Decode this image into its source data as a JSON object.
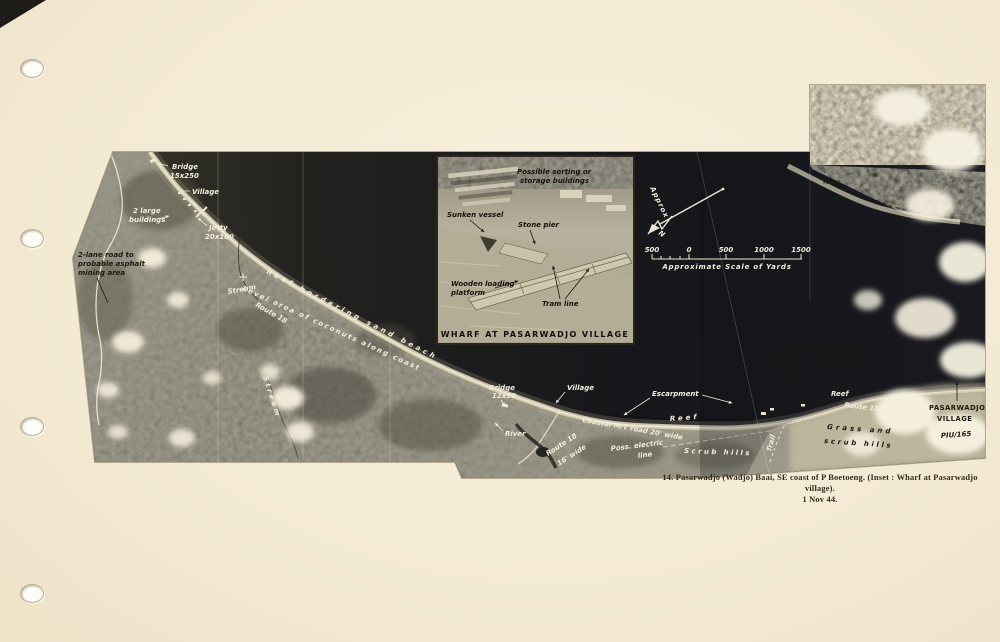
{
  "page": {
    "caption": {
      "line1": "14.  Pasarwadjo (Wadjo) Baai, SE coast of P Boetoeng.   (Inset :  Wharf at Pasarwadjo village).",
      "line2": "1 Nov 44."
    }
  },
  "colors": {
    "page_bg": "#f4ebd6",
    "sea_dark": "#1c1c1f",
    "land": "#87836f",
    "label_light": "#f1ecdb",
    "label_dark": "#1c1913"
  },
  "photo": {
    "annotations": {
      "bridge_nw_1": "Bridge",
      "bridge_nw_2": "15x250",
      "village_nw": "Village",
      "large_bldgs_nw_1": "2 large",
      "large_bldgs_nw_2": "buildings",
      "jetty_1": "Jetty",
      "jetty_2": "20x100",
      "two_lane_1": "2-lane road to",
      "two_lane_2": "probable asphalt",
      "two_lane_3": "mining area",
      "stream": "Stream",
      "stream_vertical": "Stream",
      "route18_nw": "Route 18",
      "coast_line1": "Reef bordering sand beach",
      "coast_line2": "Level area of coconuts along coast",
      "bridge_s_1": "Bridge",
      "bridge_s_2": "12x50",
      "river": "River",
      "village_s": "Village",
      "escarpment": "Escarpment",
      "coastal_road": "Coastal M/T road 20' wide",
      "route18_s_1": "Route 18",
      "route18_s_2": "16' wide",
      "poss_electric_1": "Poss. electric",
      "poss_electric_2": "line",
      "reef_mid": "Reef",
      "scrub_hills": "Scrub hills",
      "reef_e": "Reef",
      "route18_e": "Route 18",
      "grass_1": "Grass and",
      "grass_2": "scrub hills",
      "trail_e": "Trail",
      "trail_ne": "Trail",
      "large_bldgs_e_1": "Large buildings, prob.",
      "large_bldgs_e_2": "Jap camp and supply",
      "large_bldgs_e_3": "point",
      "pasarwadjo_1": "PASARWADJO",
      "pasarwadjo_2": "VILLAGE",
      "photo_ref": "PIU/165"
    },
    "compass": {
      "approx": "Approx",
      "north": "N"
    },
    "scale_bar": {
      "ticks": [
        "500",
        "0",
        "500",
        "1000",
        "1500"
      ],
      "label": "Approximate Scale of Yards"
    },
    "inset": {
      "title": "WHARF AT PASARWADJO VILLAGE",
      "labels": {
        "sorting_1": "Possible sorting or",
        "sorting_2": "storage buildings",
        "sunken_vessel": "Sunken vessel",
        "stone_pier": "Stone pier",
        "platform_1": "Wooden loading",
        "platform_2": "platform",
        "tram_line": "Tram line"
      }
    }
  }
}
